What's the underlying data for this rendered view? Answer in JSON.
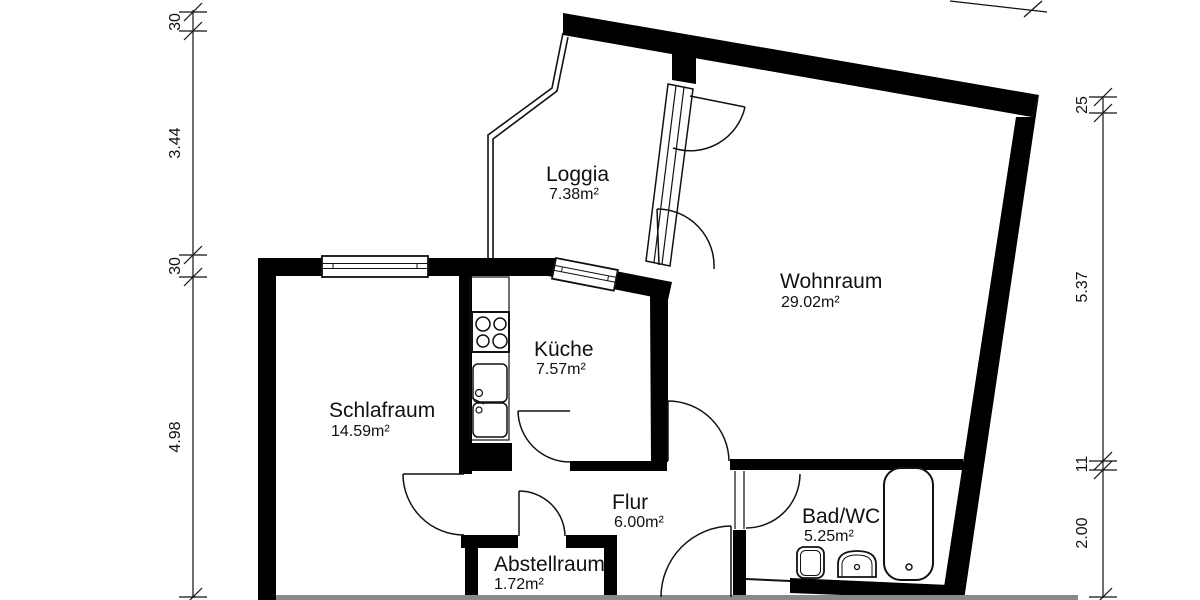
{
  "title": "Wohnungsgrundriss",
  "rooms": {
    "loggia": {
      "name": "Loggia",
      "area": "7.38m²"
    },
    "wohnraum": {
      "name": "Wohnraum",
      "area": "29.02m²"
    },
    "kueche": {
      "name": "Küche",
      "area": "7.57m²"
    },
    "schlafraum": {
      "name": "Schlafraum",
      "area": "14.59m²"
    },
    "flur": {
      "name": "Flur",
      "area": "6.00m²"
    },
    "bad": {
      "name": "Bad/WC",
      "area": "5.25m²"
    },
    "abstellraum": {
      "name": "Abstellraum",
      "area": "1.72m²"
    }
  },
  "dimensions": {
    "left": [
      "30",
      "3.44",
      "30",
      "4.98"
    ],
    "right": [
      "25",
      "5.37",
      "11",
      "2.00"
    ]
  },
  "colors": {
    "wall": "#000000",
    "line": "#111111",
    "background": "#ffffff",
    "cut_edge": "#8a8a8a"
  }
}
